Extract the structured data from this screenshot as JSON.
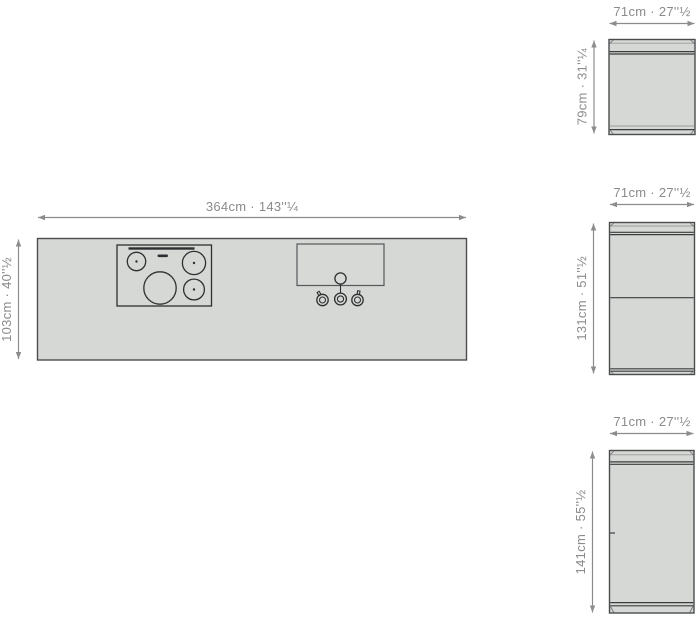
{
  "diagram": {
    "type": "kitchen-island-dimension-drawing",
    "plan": {
      "width_label": "364cm · 143''¼",
      "depth_label": "103cm · 40''½",
      "features": [
        "cooktop-four-burners",
        "sink-with-faucet-and-two-knobs"
      ]
    },
    "elevations": [
      {
        "id": "elevation-top",
        "width_label": "71cm · 27''½",
        "height_label": "79cm · 31''¼"
      },
      {
        "id": "elevation-middle",
        "width_label": "71cm · 27''½",
        "height_label": "131cm · 51''½"
      },
      {
        "id": "elevation-bottom",
        "width_label": "71cm · 27''½",
        "height_label": "141cm · 55''½"
      }
    ],
    "colors": {
      "background": "#ffffff",
      "surface_fill": "#d6d8d5",
      "outline": "#4b4c4e",
      "detail_dark": "#2e2f31",
      "dimension_line": "#8c8c8c",
      "label_text": "#8a8b8a"
    }
  }
}
